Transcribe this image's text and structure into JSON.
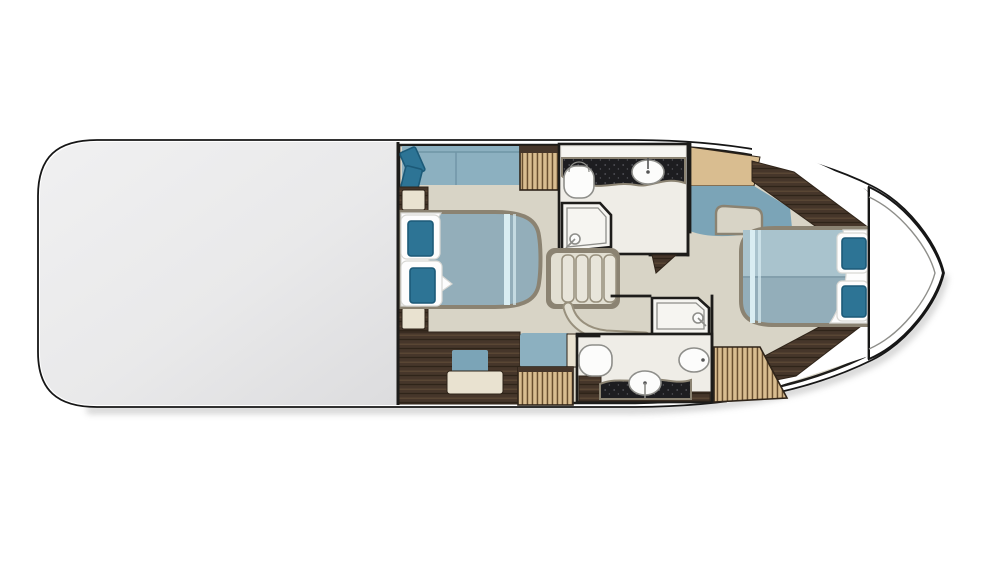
{
  "meta": {
    "title": "Motor yacht lower-deck floor plan, side-on top view, bow pointing right",
    "visible_text": "none"
  },
  "colors": {
    "page_bg": "#ffffff",
    "hull_fill": "#ffffff",
    "hull_line": "#161616",
    "deck_gray": "#ececed",
    "deck_gray_dark": "#dadadc",
    "shadow": "#8f8f8f",
    "floor": "#d8d4c6",
    "floor_light": "#e2dfd2",
    "room_floor": "#efede7",
    "room_band": "#f6f5f1",
    "wall_black": "#1d1c1a",
    "wall_taupe": "#8b8372",
    "wood_dark": "#46362a",
    "wood_streak_light": "#5f4b38",
    "wood_streak_dark": "#2f2419",
    "wood_light": "#d9bd90",
    "louver_slat": "#6a5030",
    "counter_black": "#1d1d20",
    "counter_speck": "#55555c",
    "upholstery_blue": "#8cb0c0",
    "upholstery_blue_dark": "#7ba4b7",
    "bed_blue": "#93aeba",
    "bed_blue_light": "#a9c3cd",
    "bed_seam": "#7e9aa8",
    "pillow_teal": "#2d7495",
    "pillow_teal_dark": "#1c5a78",
    "stripe_light": "#d9edf2",
    "linen_white": "#fdfdfd",
    "linen_shadow": "#d8d8d4",
    "fixture_white": "#fcfcfb",
    "fixture_stroke": "#8e8e8a",
    "step_fill": "#e8e5da",
    "step_stroke": "#98907d",
    "cream": "#e9e2d0"
  },
  "rooms": [
    {
      "id": "aft-deck-overlay",
      "label": "Aft section covered by main deck (gray silhouette)"
    },
    {
      "id": "midship-cabin",
      "label": "Midship master cabin with double bed, sofa, vanity and wardrobes"
    },
    {
      "id": "day-head",
      "label": "Upper bathroom with sink counter, toilet and shower"
    },
    {
      "id": "staircase",
      "label": "Companionway stairs with curved rail"
    },
    {
      "id": "ensuite-bathroom",
      "label": "Lower bathroom with shower, toilet, sink counter and bidet"
    },
    {
      "id": "forward-cabin",
      "label": "Forward VIP cabin with island bed, chaise, desk and wardrobe"
    },
    {
      "id": "bow-deck",
      "label": "Bow deck (white, pointed)"
    }
  ],
  "furniture": {
    "midship_sofa": "Blue two-seat sofa with two teal cushions",
    "midship_wardrobe_top": "Louvered wardrobe",
    "midship_nightstand_top": "Nightstand",
    "midship_bed": "Double bed, blue duvet, white sheet, two teal pillows, light foot stripes",
    "midship_nightstand_bottom": "Nightstand",
    "midship_vanity": "Dark wood vanity with cream desktop and blue stool",
    "midship_bench": "Blue bench seat",
    "midship_wardrobe_bottom": "Louvered wardrobe",
    "day_head_fixtures": [
      "toilet",
      "sink on black counter",
      "shower with head"
    ],
    "ensuite_fixtures": [
      "shower with head",
      "toilet",
      "sink on black counter",
      "bidet"
    ],
    "forward_desk": "Light wood desk/vanity top",
    "forward_chaise": "Blue chaise seat with floor cutout",
    "forward_wardrobe": "Angled louvered wardrobe",
    "forward_bed": "Island double bed, blue duvet, white sheet, two teal pillows, head at bow side"
  }
}
